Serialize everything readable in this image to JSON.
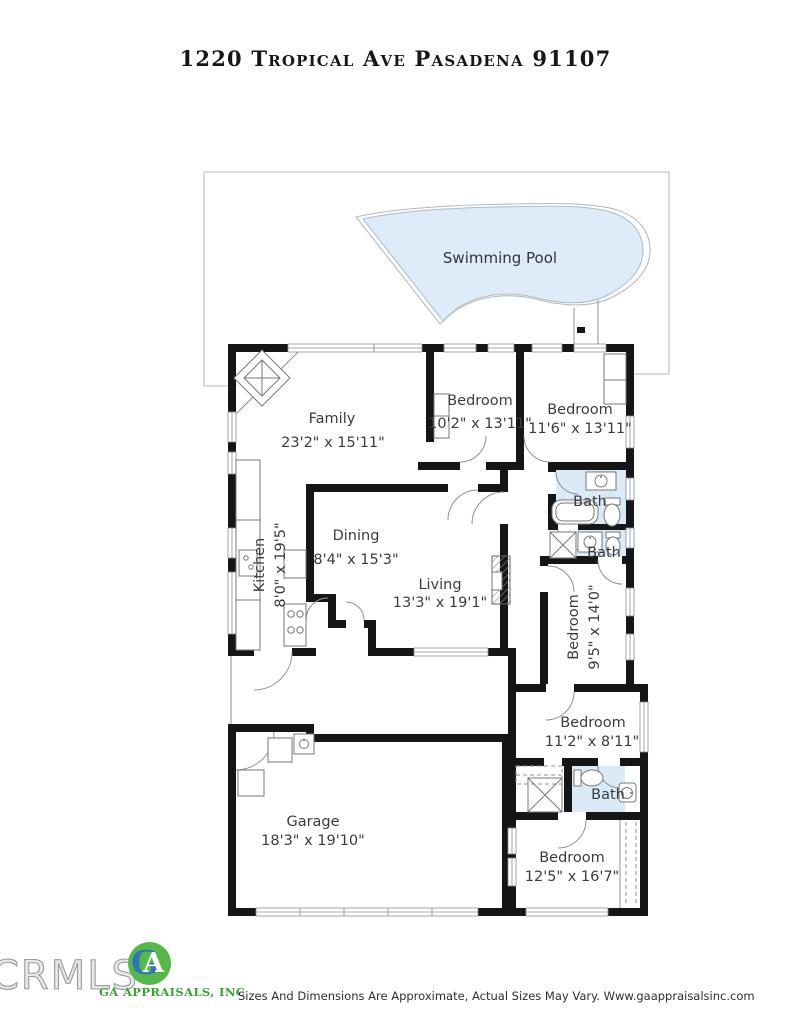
{
  "title": "1220 Tropical Ave Pasadena 91107",
  "pool": {
    "label": "Swimming Pool"
  },
  "rooms": [
    {
      "id": "family",
      "label": "Family",
      "dims": "23'2\" x 15'11\""
    },
    {
      "id": "bedroom-top-middle",
      "label": "Bedroom",
      "dims": "10'2\" x 13'11\""
    },
    {
      "id": "bedroom-top-right",
      "label": "Bedroom",
      "dims": "11'6\" x 13'11\""
    },
    {
      "id": "bath-upper",
      "label": "Bath"
    },
    {
      "id": "bath-middle",
      "label": "Bath"
    },
    {
      "id": "kitchen",
      "label": "Kitchen",
      "dims": "8'0\" x 19'5\""
    },
    {
      "id": "dining",
      "label": "Dining",
      "dims": "8'4\" x 15'3\""
    },
    {
      "id": "living",
      "label": "Living",
      "dims": "13'3\" x 19'1\""
    },
    {
      "id": "bedroom-right",
      "label": "Bedroom",
      "dims": "9'5\" x 14'0\""
    },
    {
      "id": "bedroom-lower-right",
      "label": "Bedroom",
      "dims": "11'2\" x 8'11\""
    },
    {
      "id": "bath-lower",
      "label": "Bath"
    },
    {
      "id": "garage",
      "label": "Garage",
      "dims": "18'3\" x 19'10\""
    },
    {
      "id": "bedroom-bottom",
      "label": "Bedroom",
      "dims": "12'5\" x 16'7\""
    }
  ],
  "footer": {
    "mls_logo": "CRMLS",
    "monogram_g": "G",
    "monogram_a": "A",
    "company": "GA APPRAISALS, INC",
    "disclaimer": "Sizes And Dimensions Are Approximate, Actual Sizes May Vary. Www.gaappraisalsinc.com"
  },
  "colors": {
    "wall": "#161616",
    "pool": "#ddecf8",
    "pool-edge": "#a9bccb",
    "bath": "#daeaf7",
    "line": "#8f8f8f",
    "ink": "#3c3c3c",
    "green": "#3aa233",
    "blue": "#2d74ba",
    "gray-logo": "#9a9a9a"
  }
}
